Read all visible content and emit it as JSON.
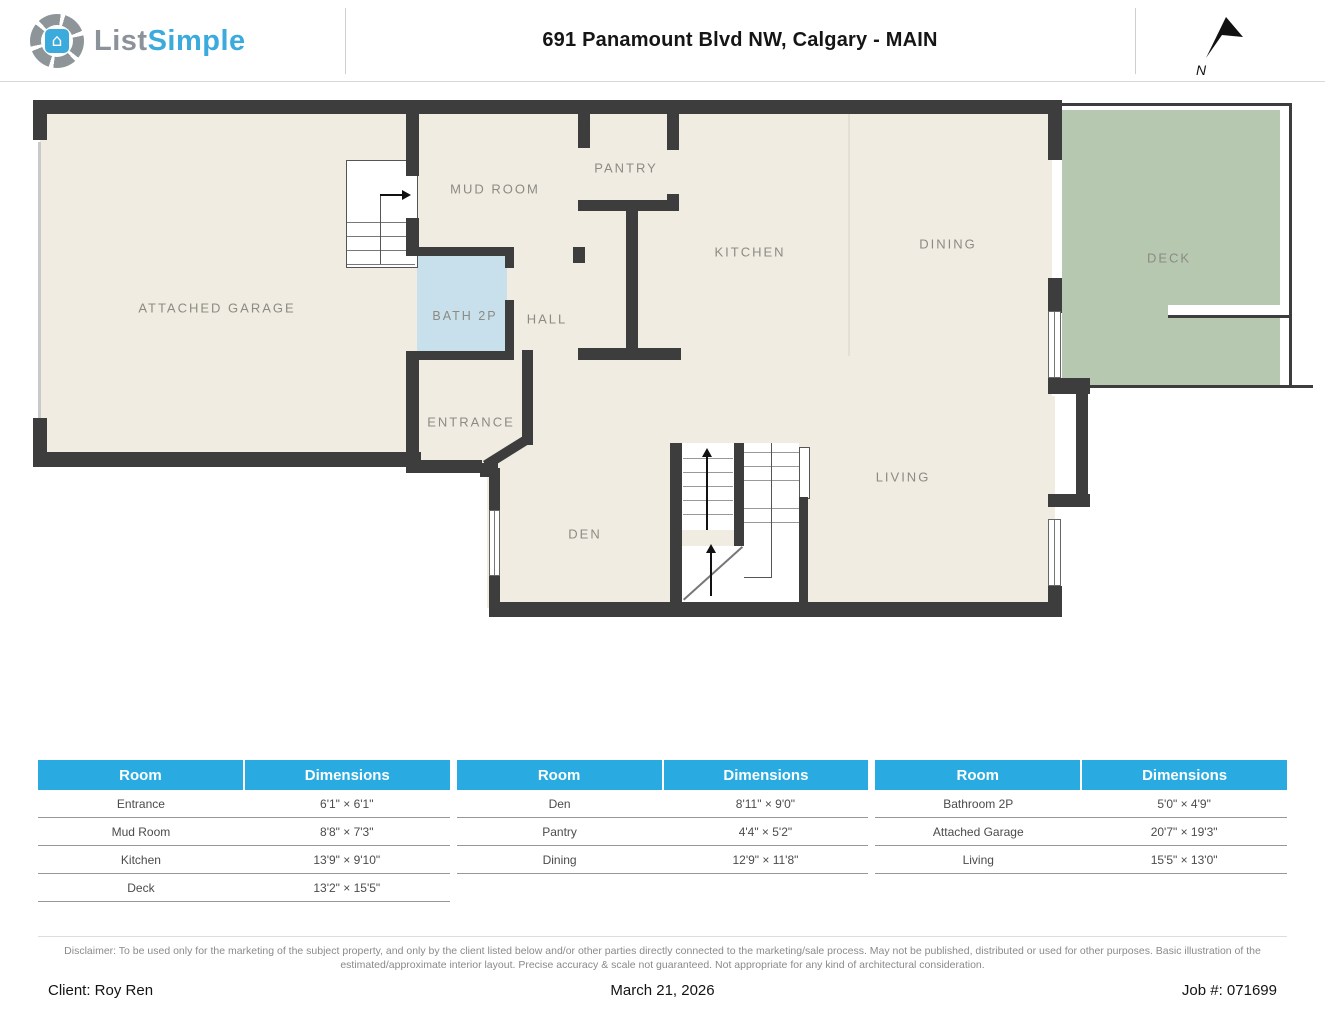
{
  "header": {
    "logo": {
      "text_primary": "List",
      "text_secondary": "Simple",
      "icon": "aperture-house-icon",
      "house_glyph": "⌂"
    },
    "title": "691 Panamount Blvd NW, Calgary - MAIN",
    "compass": {
      "label": "N",
      "icon": "north-arrow-icon"
    }
  },
  "plan": {
    "rooms": {
      "garage": "ATTACHED GARAGE",
      "mud_room": "MUD ROOM",
      "pantry": "PANTRY",
      "kitchen": "KITCHEN",
      "dining": "DINING",
      "deck": "DECK",
      "bath": "BATH 2P",
      "hall": "HALL",
      "entrance": "ENTRANCE",
      "den": "DEN",
      "living": "LIVING"
    },
    "colors": {
      "wall": "#3d3d3d",
      "floor": "#f1ece2",
      "bath_fill": "#c7e0eb",
      "deck_fill": "#b7c8b0",
      "label": "#8b8b84"
    }
  },
  "table": {
    "headers": {
      "room": "Room",
      "dimensions": "Dimensions"
    },
    "header_bg": "#29abe2",
    "groups": [
      {
        "rows": [
          {
            "room": "Entrance",
            "dims": "6'1\" × 6'1\""
          },
          {
            "room": "Mud Room",
            "dims": "8'8\" × 7'3\""
          },
          {
            "room": "Kitchen",
            "dims": "13'9\" × 9'10\""
          },
          {
            "room": "Deck",
            "dims": "13'2\" × 15'5\""
          }
        ]
      },
      {
        "rows": [
          {
            "room": "Den",
            "dims": "8'11\" × 9'0\""
          },
          {
            "room": "Pantry",
            "dims": "4'4\" × 5'2\""
          },
          {
            "room": "Dining",
            "dims": "12'9\" × 11'8\""
          }
        ]
      },
      {
        "rows": [
          {
            "room": "Bathroom 2P",
            "dims": "5'0\" × 4'9\""
          },
          {
            "room": "Attached Garage",
            "dims": "20'7\" × 19'3\""
          },
          {
            "room": "Living",
            "dims": "15'5\" × 13'0\""
          }
        ]
      }
    ]
  },
  "footer": {
    "disclaimer": "Disclaimer: To be used only for the marketing of the subject property, and only by the client listed below and/or other parties directly connected to the marketing/sale process. May not be published, distributed or used for other purposes. Basic illustration of the estimated/approximate interior layout. Precise accuracy & scale not guaranteed. Not appropriate for any kind of architectural consideration.",
    "client": "Client: Roy Ren",
    "date": "March 21, 2026",
    "job": "Job #: 071699"
  }
}
